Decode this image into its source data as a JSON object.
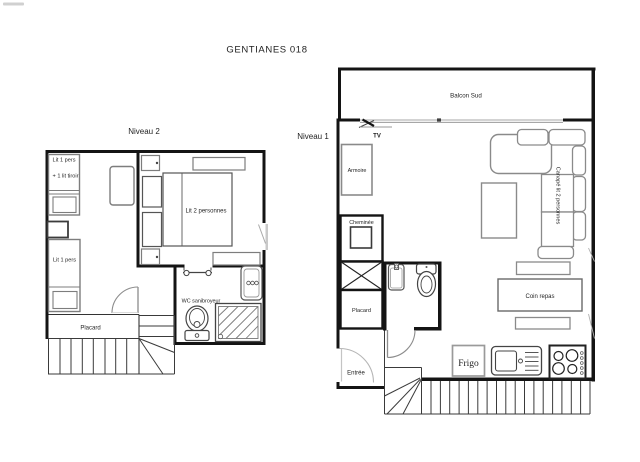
{
  "title": "GENTIANES 018",
  "colors": {
    "background": "#ffffff",
    "walls": "#141414",
    "furniture_outline": "#7d7d7d",
    "fixture_outline": "#555555",
    "text": "#1f1f1f"
  },
  "levels": {
    "niveau2": {
      "label": "Niveau 2",
      "labels": {
        "bed_single_top_line1": "Lit 1 pers",
        "bed_single_top_line2": "+ 1 lit tiroir",
        "bed_single_bottom": "Lit 1 pers",
        "bed_double": "Lit 2 personnes",
        "closet": "Placard",
        "wc": "WC sanibroyeur"
      }
    },
    "niveau1": {
      "label": "Niveau 1",
      "labels": {
        "balcony": "Balcon Sud",
        "tv": "TV",
        "wardrobe": "Armoire",
        "fireplace": "Cheminée",
        "closet": "Placard",
        "dining": "Coin repas",
        "sofa": "Canapé lit 2 personnes",
        "entrance": "Entrée",
        "fridge": "Frigo"
      }
    }
  }
}
